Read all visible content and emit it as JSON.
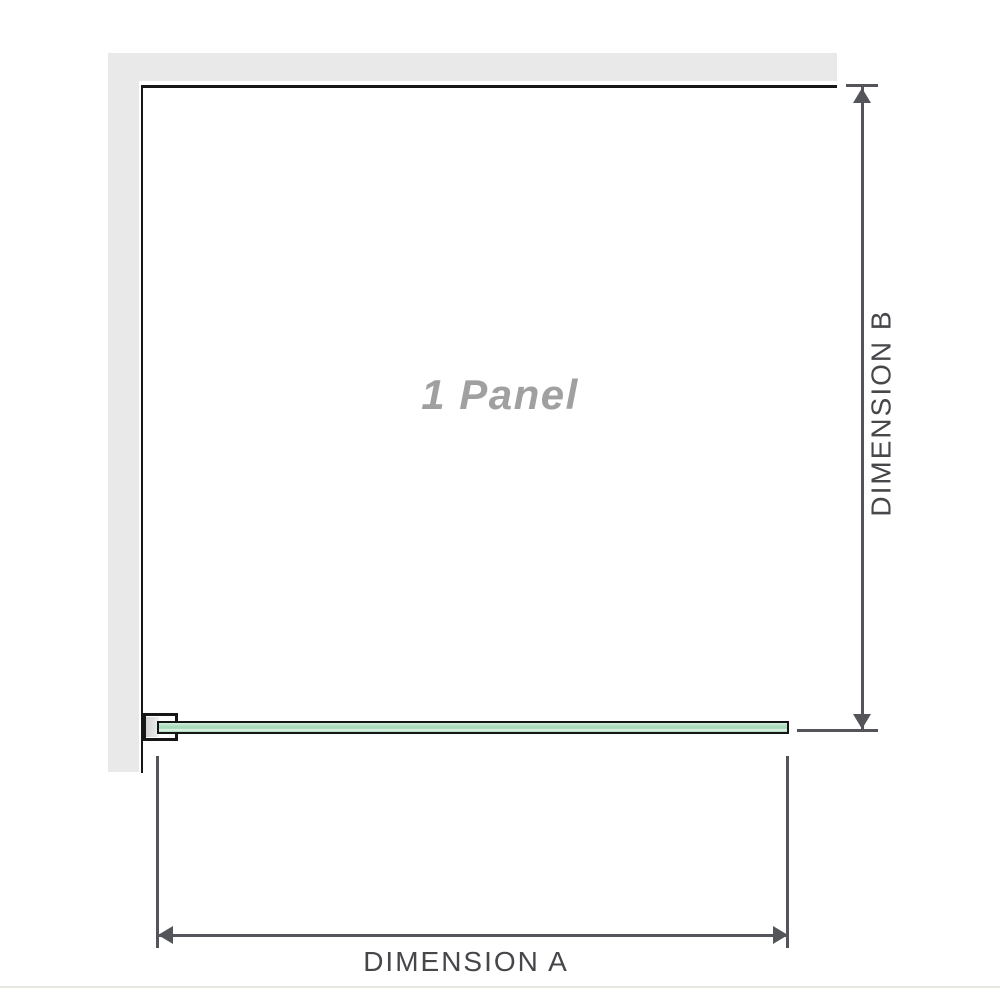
{
  "diagram": {
    "panel_label": "1 Panel",
    "dimension_a_label": "DIMENSION A",
    "dimension_b_label": "DIMENSION B"
  },
  "colors": {
    "wall": "#e9e9e9",
    "outline": "#161616",
    "dimension": "#54555a",
    "label": "#46474b",
    "panel_label": "#a0a0a0",
    "glass_light": "#d3eedd",
    "glass": "#a8dbba",
    "glass_highlight": "#eaf6ef",
    "bracket_inner": "#d2d2d2",
    "baseline": "#e8e7e2"
  }
}
